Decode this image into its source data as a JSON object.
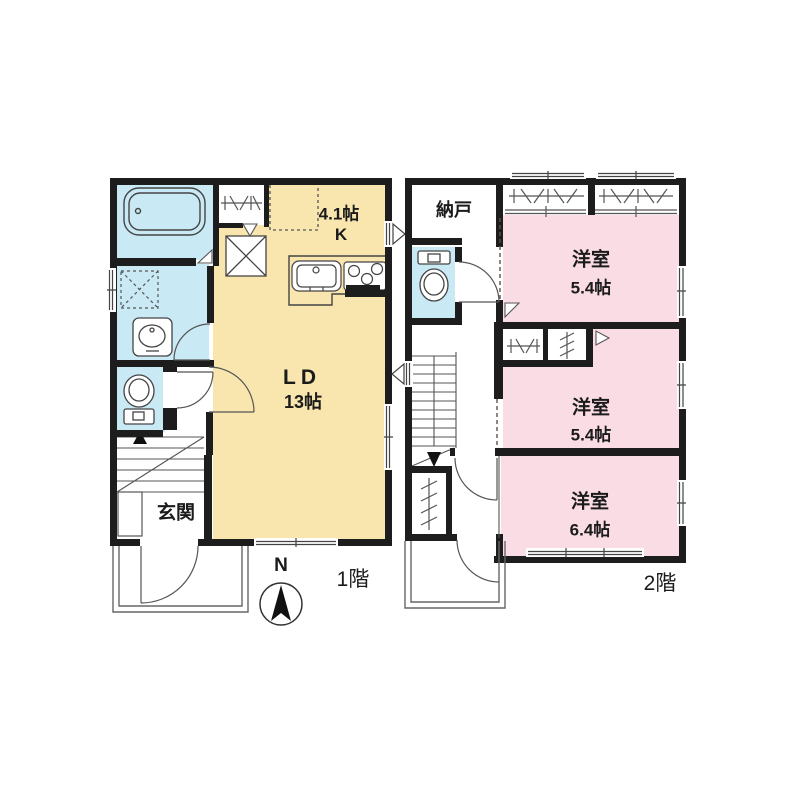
{
  "colors": {
    "wall": "#1d1d1d",
    "ldk": "#f8e6ae",
    "bedroom": "#fadde4",
    "wet": "#c9e9f4",
    "white": "#ffffff"
  },
  "compass": {
    "north_label": "N"
  },
  "floor1": {
    "floor_label": "1階",
    "kitchen": {
      "size": "4.1帖",
      "type": "K"
    },
    "living": {
      "type": "LD",
      "size": "13帖"
    },
    "entrance_label": "玄関"
  },
  "floor2": {
    "floor_label": "2階",
    "storage_label": "納戸",
    "bedrooms": [
      {
        "name": "洋室",
        "size": "5.4帖"
      },
      {
        "name": "洋室",
        "size": "5.4帖"
      },
      {
        "name": "洋室",
        "size": "6.4帖"
      }
    ]
  }
}
